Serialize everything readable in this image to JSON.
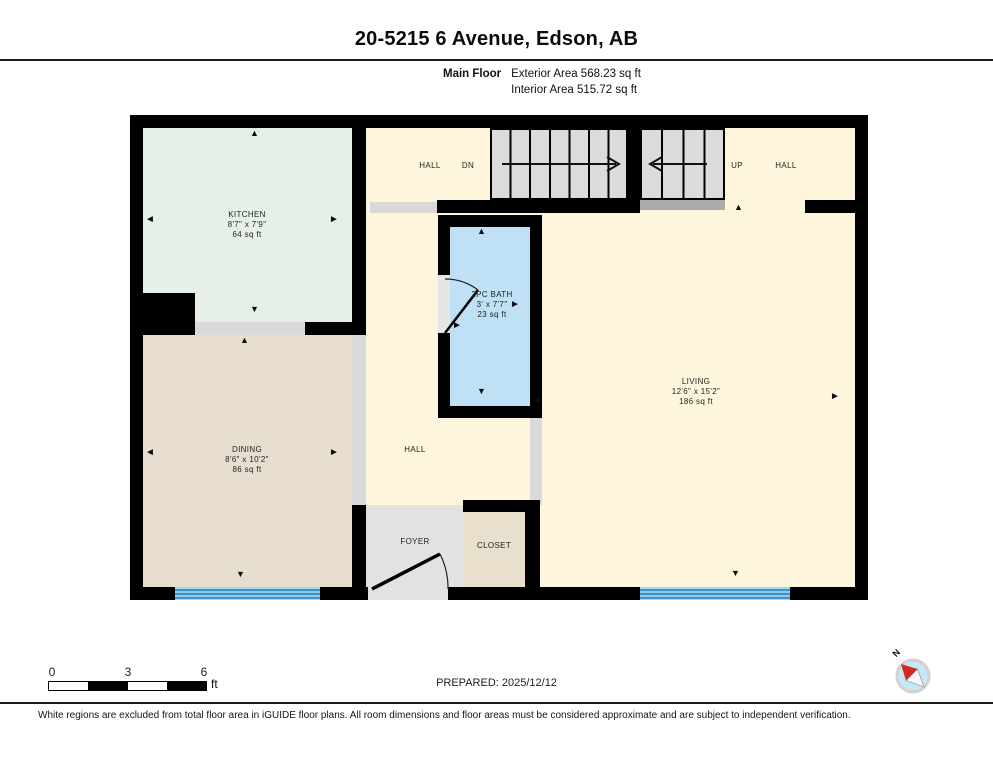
{
  "header": {
    "title": "20-5215 6 Avenue, Edson, AB",
    "floor_label": "Main Floor",
    "exterior_area": "Exterior Area 568.23 sq ft",
    "interior_area": "Interior Area 515.72 sq ft"
  },
  "rooms": {
    "kitchen": {
      "name": "KITCHEN",
      "dims": "8'7\" x 7'9\"",
      "area": "64 sq ft"
    },
    "dining": {
      "name": "DINING",
      "dims": "8'6\" x 10'2\"",
      "area": "86 sq ft"
    },
    "bath": {
      "name": "2PC BATH",
      "dims": "3' x 7'7\"",
      "area": "23 sq ft"
    },
    "living": {
      "name": "LIVING",
      "dims": "12'6\" x 15'2\"",
      "area": "186 sq ft"
    },
    "hall_upper_left": "HALL",
    "hall_upper_right": "HALL",
    "hall_middle": "HALL",
    "foyer": "FOYER",
    "closet": "CLOSET"
  },
  "stairs": {
    "down_label": "DN",
    "up_label": "UP"
  },
  "icons": {
    "arrow_up": "▲",
    "arrow_down": "▼",
    "arrow_left": "◄",
    "arrow_right": "►",
    "compass_north": "N"
  },
  "footer": {
    "scale_ticks": [
      "0",
      "3",
      "6"
    ],
    "scale_unit": "ft",
    "prepared": "PREPARED: 2025/12/12",
    "disclaimer": "White regions are excluded from total floor area in iGUIDE floor plans. All room dimensions and floor areas must be considered approximate and are subject to independent verification."
  },
  "colors": {
    "wall": "#000000",
    "hall": "#fdf6dd",
    "kitchen": "#e6f0e9",
    "dining": "#e7decf",
    "closet": "#e8dfcc",
    "bath": "#bfe0f5",
    "foyer": "#e2e2e2",
    "stairs": "#dcdcdc",
    "window": "#4aa2d6"
  }
}
